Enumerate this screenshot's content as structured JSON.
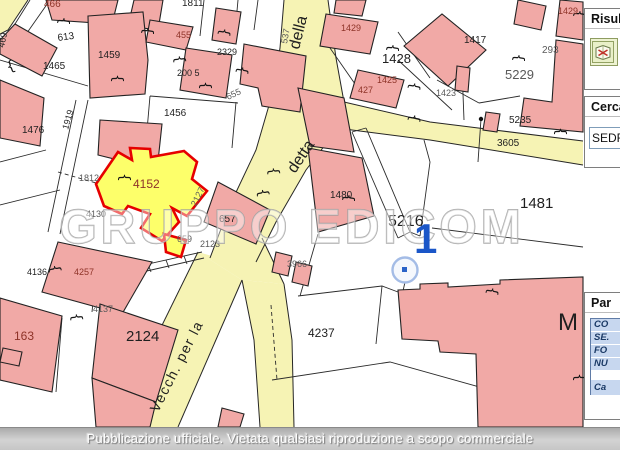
{
  "map": {
    "watermark": "GRUPPO EDICOM",
    "marker": {
      "label": "1"
    },
    "labels": [
      {
        "t": "466",
        "x": 44,
        "y": 7,
        "c": "red",
        "s": 10
      },
      {
        "t": "469",
        "x": 4,
        "y": 48,
        "r": -78,
        "c": "black",
        "s": 9
      },
      {
        "t": "613",
        "x": 58,
        "y": 41,
        "r": -8,
        "c": "black",
        "s": 10
      },
      {
        "t": "1465",
        "x": 43,
        "y": 69,
        "c": "black",
        "s": 10
      },
      {
        "t": "1459",
        "x": 98,
        "y": 58,
        "c": "black",
        "s": 10
      },
      {
        "t": "1811",
        "x": 182,
        "y": 6,
        "c": "black",
        "s": 10
      },
      {
        "t": "455",
        "x": 176,
        "y": 38,
        "c": "red",
        "s": 9
      },
      {
        "t": "2329",
        "x": 217,
        "y": 55,
        "c": "black",
        "s": 9
      },
      {
        "t": "200 5",
        "x": 177,
        "y": 76,
        "c": "black",
        "s": 9
      },
      {
        "t": "1456",
        "x": 164,
        "y": 116,
        "c": "black",
        "s": 10
      },
      {
        "t": "655",
        "x": 228,
        "y": 100,
        "r": -25,
        "c": "gray",
        "s": 9
      },
      {
        "t": "537",
        "x": 287,
        "y": 44,
        "r": -80,
        "c": "gray",
        "s": 9
      },
      {
        "t": "della",
        "x": 299,
        "y": 50,
        "r": -76,
        "c": "black",
        "s": 16,
        "street": true
      },
      {
        "t": "1429",
        "x": 341,
        "y": 31,
        "c": "red",
        "s": 9
      },
      {
        "t": "1428",
        "x": 382,
        "y": 63,
        "c": "black",
        "s": 13
      },
      {
        "t": "1425",
        "x": 377,
        "y": 83,
        "c": "red",
        "s": 9
      },
      {
        "t": "427",
        "x": 358,
        "y": 93,
        "c": "red",
        "s": 9
      },
      {
        "t": "1423",
        "x": 436,
        "y": 96,
        "c": "gray",
        "s": 9
      },
      {
        "t": "1417",
        "x": 464,
        "y": 43,
        "c": "black",
        "s": 10
      },
      {
        "t": "293",
        "x": 542,
        "y": 53,
        "c": "gray",
        "s": 10
      },
      {
        "t": "1429",
        "x": 558,
        "y": 14,
        "c": "red",
        "s": 9
      },
      {
        "t": "5229",
        "x": 505,
        "y": 79,
        "c": "gray",
        "s": 13
      },
      {
        "t": "5235",
        "x": 509,
        "y": 123,
        "c": "black",
        "s": 10
      },
      {
        "t": "3605",
        "x": 497,
        "y": 146,
        "c": "black",
        "s": 10
      },
      {
        "t": "1476",
        "x": 22,
        "y": 133,
        "c": "black",
        "s": 10
      },
      {
        "t": "1919",
        "x": 68,
        "y": 130,
        "r": -74,
        "c": "black",
        "s": 9
      },
      {
        "t": "1812",
        "x": 79,
        "y": 181,
        "c": "gray",
        "s": 9
      },
      {
        "t": "4130",
        "x": 86,
        "y": 217,
        "c": "gray",
        "s": 9
      },
      {
        "t": "4152",
        "x": 133,
        "y": 188,
        "c": "red",
        "s": 12
      },
      {
        "t": "2127",
        "x": 196,
        "y": 207,
        "r": -64,
        "c": "gray",
        "s": 9
      },
      {
        "t": "657",
        "x": 219,
        "y": 222,
        "c": "black",
        "s": 10
      },
      {
        "t": "659",
        "x": 177,
        "y": 242,
        "c": "gray",
        "s": 9
      },
      {
        "t": "2123",
        "x": 200,
        "y": 247,
        "c": "gray",
        "s": 9
      },
      {
        "t": "1480",
        "x": 330,
        "y": 198,
        "c": "black",
        "s": 10
      },
      {
        "t": "detta",
        "x": 295,
        "y": 174,
        "r": -56,
        "c": "black",
        "s": 16,
        "street": true
      },
      {
        "t": "5216",
        "x": 388,
        "y": 226,
        "c": "black",
        "s": 16
      },
      {
        "t": "1481",
        "x": 520,
        "y": 208,
        "c": "black",
        "s": 15
      },
      {
        "t": "3966",
        "x": 287,
        "y": 267,
        "c": "gray",
        "s": 9
      },
      {
        "t": "4136",
        "x": 27,
        "y": 275,
        "c": "black",
        "s": 9
      },
      {
        "t": "4257",
        "x": 74,
        "y": 275,
        "c": "red",
        "s": 9
      },
      {
        "t": "4137",
        "x": 93,
        "y": 312,
        "c": "gray",
        "s": 9
      },
      {
        "t": "163",
        "x": 14,
        "y": 340,
        "c": "red",
        "s": 12
      },
      {
        "t": "2124",
        "x": 126,
        "y": 341,
        "c": "black",
        "s": 15
      },
      {
        "t": "4237",
        "x": 308,
        "y": 337,
        "c": "black",
        "s": 12
      },
      {
        "t": "M",
        "x": 558,
        "y": 330,
        "c": "black",
        "s": 24
      },
      {
        "t": "Vecch. per la",
        "x": 158,
        "y": 413,
        "r": -63,
        "c": "black",
        "s": 14,
        "street": true,
        "ls": 1.5
      }
    ],
    "braces": [
      {
        "x": 60,
        "y": 16,
        "r": 95
      },
      {
        "x": 113,
        "y": 74,
        "r": 90
      },
      {
        "x": 8,
        "y": 72,
        "r": -20
      },
      {
        "x": 221,
        "y": 27,
        "r": 100
      },
      {
        "x": 175,
        "y": 55,
        "r": 85
      },
      {
        "x": 201,
        "y": 81,
        "r": 90
      },
      {
        "x": 239,
        "y": 65,
        "r": 100
      },
      {
        "x": 389,
        "y": 43,
        "r": 95
      },
      {
        "x": 411,
        "y": 81,
        "r": 100
      },
      {
        "x": 411,
        "y": 113,
        "r": 100
      },
      {
        "x": 515,
        "y": 53,
        "r": 95
      },
      {
        "x": 556,
        "y": 127,
        "r": 90
      },
      {
        "x": 576,
        "y": 9,
        "r": 95
      },
      {
        "x": 345,
        "y": 193,
        "r": 95
      },
      {
        "x": 269,
        "y": 167,
        "r": 85
      },
      {
        "x": 258,
        "y": 189,
        "r": 80
      },
      {
        "x": 489,
        "y": 286,
        "r": 100
      },
      {
        "x": 50,
        "y": 265,
        "r": 80
      },
      {
        "x": 72,
        "y": 313,
        "r": 85
      },
      {
        "x": 120,
        "y": 173,
        "r": 90
      },
      {
        "x": 575,
        "y": 373,
        "r": 90
      },
      {
        "x": 144,
        "y": 26,
        "r": 95
      }
    ]
  },
  "sidebar": {
    "results_panel": {
      "title": "Risult",
      "icon": "map-report-icon"
    },
    "search_panel": {
      "title": "Cerca",
      "input_value": "SEDR"
    },
    "parcel_panel": {
      "title": "Par",
      "rows": [
        "CO",
        "SE.",
        "FO",
        "NU",
        "Ca"
      ]
    }
  },
  "footer": {
    "text": "Pubblicazione ufficiale. Vietata qualsiasi riproduzione a scopo commerciale"
  },
  "colors": {
    "highlight_fill": "#fdff6a",
    "highlight_border": "#e60000",
    "road_fill": "#f6f3b4",
    "building_fill": "#f1a9a6",
    "marker_blue": "#1a56c8"
  }
}
